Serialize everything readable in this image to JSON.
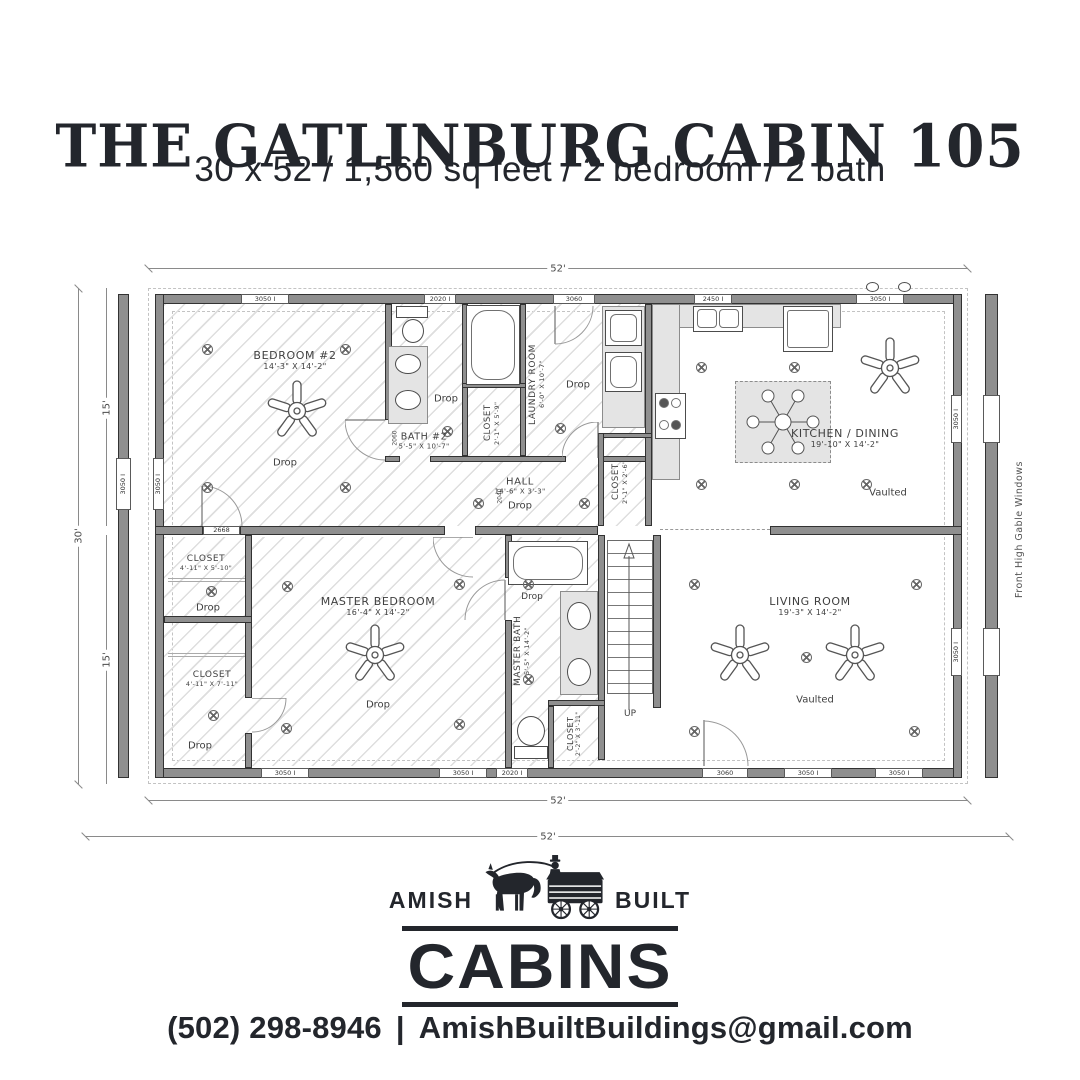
{
  "header": {
    "title": "THE GATLINBURG CABIN 105",
    "subtitle": "30 x 52 / 1,560 sq feet / 2 bedroom / 2 bath"
  },
  "plan": {
    "dims": {
      "width_top": "52'",
      "width_bottom": "52'",
      "width_overall": "52'",
      "height_overall": "30'",
      "height_upper": "15'",
      "height_lower": "15'"
    },
    "side_note": "Front High Gable Windows",
    "stairs_label": "UP",
    "rooms": {
      "bedroom2": {
        "name": "BEDROOM #2",
        "size": "14'-3\" X 14'-2\"",
        "note": "Drop"
      },
      "bath2": {
        "name": "BATH #2",
        "size": "5'-5\" X 10'-7\"",
        "note": "Drop"
      },
      "closet_bath2": {
        "name": "CLOSET",
        "size": "2'-1\" X 5'-9\""
      },
      "laundry": {
        "name": "LAUNDRY ROOM",
        "size": "6'-0\" X 10'-7\"",
        "note": "Drop"
      },
      "closet_laundry": {
        "name": "CLOSET",
        "size": "2'-1\" X 2'-6\""
      },
      "hall": {
        "name": "HALL",
        "size": "14'-6\" X 3'-3\"",
        "note": "Drop"
      },
      "kitchen": {
        "name": "KITCHEN / DINING",
        "size": "19'-10\" X 14'-2\"",
        "note": "Vaulted"
      },
      "closet1": {
        "name": "CLOSET",
        "size": "4'-11\" X 5'-10\"",
        "note": "Drop"
      },
      "closet2": {
        "name": "CLOSET",
        "size": "4'-11\" X 7'-11\"",
        "note": "Drop"
      },
      "master_bedroom": {
        "name": "MASTER BEDROOM",
        "size": "16'-4\" X 14'-2\"",
        "note": "Drop"
      },
      "master_bath": {
        "name": "MASTER BATH",
        "size": "5'-5\" X 14'-2\"",
        "note": "Drop"
      },
      "closet_mbath": {
        "name": "CLOSET",
        "size": "2'-2\" X 3'-11\""
      },
      "living": {
        "name": "LIVING ROOM",
        "size": "19'-3\" X 14'-2\"",
        "note": "Vaulted"
      }
    },
    "window_labels": {
      "w3050": "3050 I",
      "w2020": "2020 I",
      "w2450": "2450 I",
      "w3060": "3060"
    },
    "door_labels": {
      "a": "2060",
      "b": "2040",
      "c": "2668"
    }
  },
  "logo": {
    "left": "AMISH",
    "right": "BUILT",
    "main": "CABINS"
  },
  "footer": {
    "phone": "(502) 298-8946",
    "separator": "|",
    "email": "AmishBuiltBuildings@gmail.com"
  },
  "colors": {
    "ink": "#23262c",
    "wall": "#8f8f8f",
    "counter": "#e4e4e4",
    "hatch": "#dedede"
  }
}
